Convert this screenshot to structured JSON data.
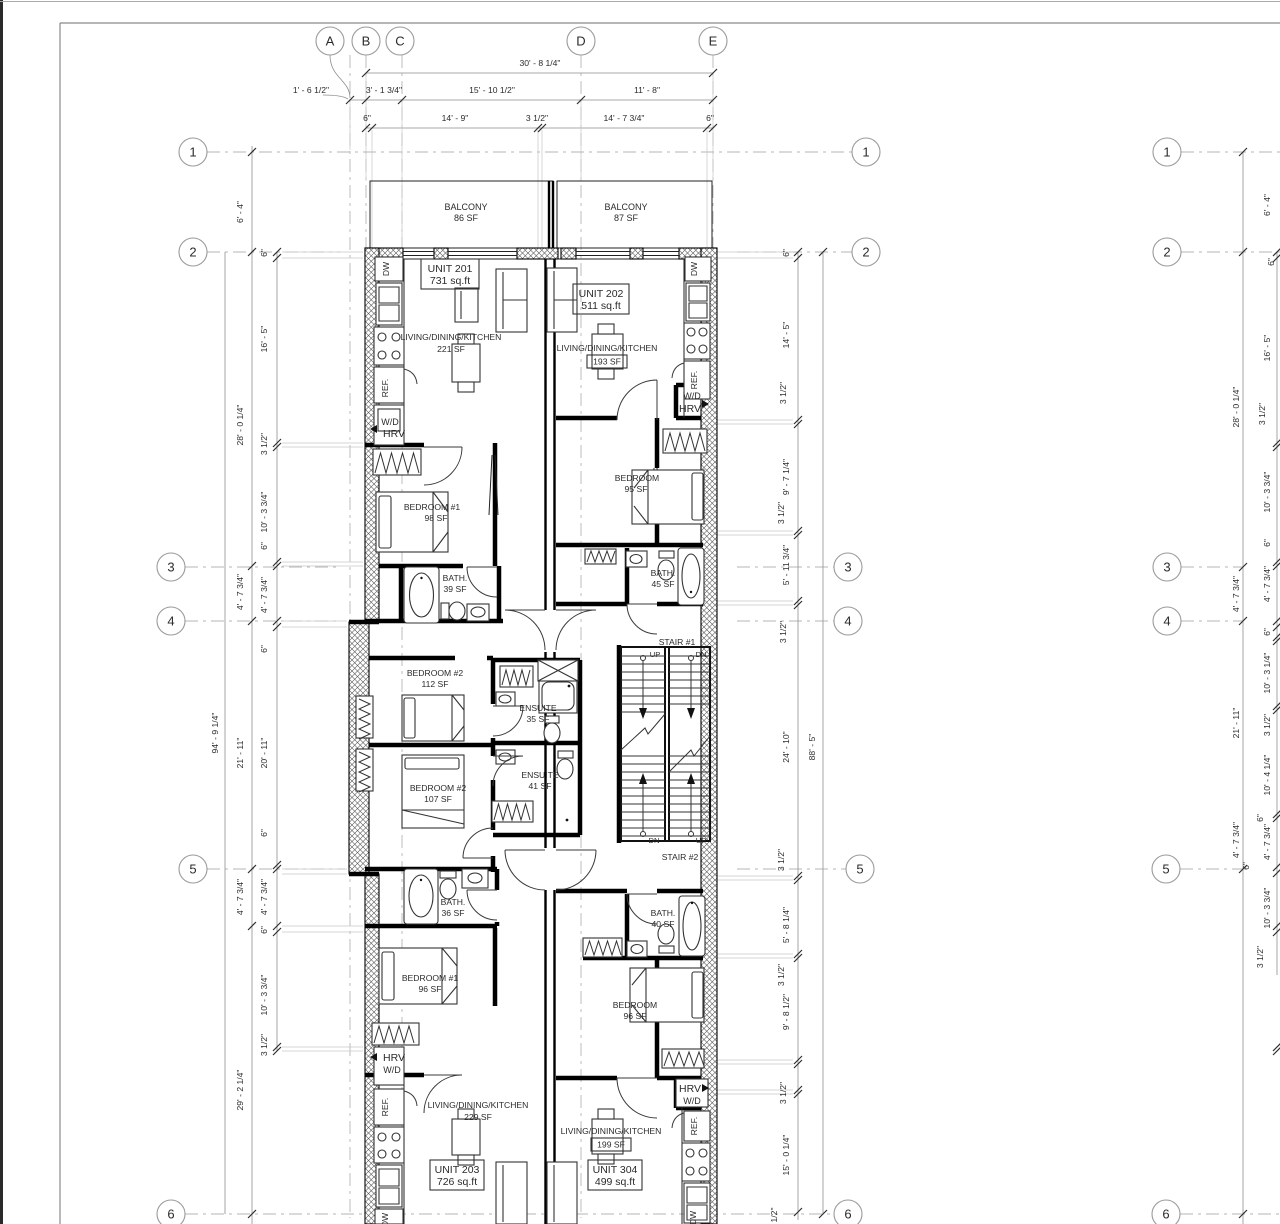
{
  "grid": {
    "cols": [
      "A",
      "B",
      "C",
      "D",
      "E"
    ],
    "rows": [
      "1",
      "2",
      "3",
      "4",
      "5",
      "6"
    ]
  },
  "dims": {
    "top": {
      "overall": "30' - 8 1/4\"",
      "row2": [
        "1' - 6 1/2\"",
        "3' - 1 3/4\"",
        "15' - 10 1/2\"",
        "11' - 8\""
      ],
      "row3": [
        "6\"",
        "14' - 9\"",
        "3 1/2\"",
        "14' - 7 3/4\"",
        "6\""
      ]
    },
    "left": {
      "overall": "94' - 9 1/4\"",
      "mid": [
        "6' - 4\"",
        "28' - 0 1/4\"",
        "4' - 7 3/4\"",
        "21' - 11\"",
        "4' - 7 3/4\"",
        "29' - 2 1/4\""
      ],
      "inner": [
        "6\"",
        "16' - 5\"",
        "3 1/2\"",
        "10' - 3 3/4\"",
        "6\"",
        "4' - 7 3/4\"",
        "6\"",
        "20' - 11\"",
        "6\"",
        "4' - 7 3/4\"",
        "6\"",
        "10' - 3 3/4\"",
        "3 1/2\""
      ]
    },
    "right": {
      "overall": "88' - 5\"",
      "inner": [
        "6\"",
        "14' - 5\"",
        "3 1/2\"",
        "9' - 7 1/4\"",
        "3 1/2\"",
        "5' - 11 3/4\"",
        "3 1/2\"",
        "24' - 10\"",
        "3 1/2\"",
        "5' - 8 1/4\"",
        "3 1/2\"",
        "9' - 8 1/2\"",
        "3 1/2\"",
        "15' - 0 1/4\"",
        "1/2\""
      ]
    },
    "far_right": {
      "mid": [
        "28' - 0 1/4\"",
        "4' - 7 3/4\"",
        "21' - 11\"",
        "4' - 7 3/4\""
      ],
      "inner": [
        "6' - 4\"",
        "6\"",
        "16' - 5\"",
        "3 1/2\"",
        "10' - 3 3/4\"",
        "6\"",
        "4' - 7 3/4\"",
        "6\"",
        "10' - 3 1/4\"",
        "3 1/2\"",
        "10' - 4 1/4\"",
        "6\"",
        "4' - 7 3/4\"",
        "6\"",
        "10' - 3 3/4\"",
        "3 1/2\""
      ]
    }
  },
  "rooms": {
    "balcony_left": {
      "name": "BALCONY",
      "area": "86 SF"
    },
    "balcony_right": {
      "name": "BALCONY",
      "area": "87 SF"
    },
    "unit201": {
      "name": "UNIT 201",
      "area": "731 sq.ft"
    },
    "unit202": {
      "name": "UNIT 202",
      "area": "511 sq.ft"
    },
    "unit203": {
      "name": "UNIT 203",
      "area": "726 sq.ft"
    },
    "unit304": {
      "name": "UNIT 304",
      "area": "499 sq.ft"
    },
    "ldk201": {
      "name": "LIVING/DINING/KITCHEN",
      "area": "221 SF"
    },
    "ldk202": {
      "name": "LIVING/DINING/KITCHEN",
      "area": "193 SF"
    },
    "ldk203": {
      "name": "LIVING/DINING/KITCHEN",
      "area": "229 SF"
    },
    "ldk304": {
      "name": "LIVING/DINING/KITCHEN",
      "area": "199 SF"
    },
    "bedroom1_201": {
      "name": "BEDROOM #1",
      "area": "98 SF"
    },
    "bedroom_202": {
      "name": "BEDROOM",
      "area": "95 SF"
    },
    "bedroom2_112": {
      "name": "BEDROOM #2",
      "area": "112 SF"
    },
    "bedroom2_107": {
      "name": "BEDROOM #2",
      "area": "107 SF"
    },
    "bedroom1_203": {
      "name": "BEDROOM #1",
      "area": "96 SF"
    },
    "bedroom_304": {
      "name": "BEDROOM",
      "area": "96 SF"
    },
    "bath_201": {
      "name": "BATH.",
      "area": "39 SF"
    },
    "bath_202": {
      "name": "BATH.",
      "area": "45 SF"
    },
    "bath_203": {
      "name": "BATH.",
      "area": "36 SF"
    },
    "bath_304": {
      "name": "BATH.",
      "area": "40 SF"
    },
    "ensuite_35": {
      "name": "ENSUITE",
      "area": "35 SF"
    },
    "ensuite_41": {
      "name": "ENSUITE",
      "area": "41 SF"
    }
  },
  "stairs": {
    "stair1": "STAIR #1",
    "stair2": "STAIR #2",
    "up": "UP",
    "dn": "DN"
  },
  "fixtures": {
    "dw": "DW",
    "ref": "REF.",
    "wd": "W/D",
    "hrv": "HRV"
  },
  "colors": {
    "line": "#000000",
    "dim": "#8f8f8f",
    "background": "#ffffff"
  }
}
